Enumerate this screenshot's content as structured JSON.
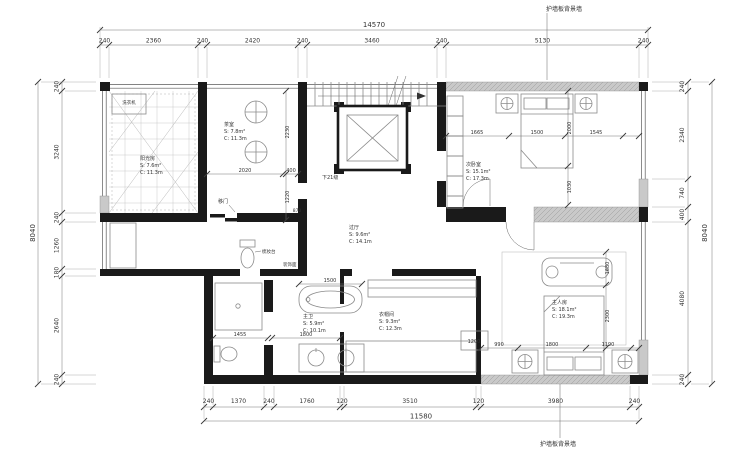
{
  "labels": {
    "panel_wall_top": "护墙板背景墙",
    "panel_wall_bottom": "护墙板背景墙",
    "stairs_note": "下21级",
    "sliding_door": "移门",
    "vanity_table": "梳妆台",
    "washer": "洗衣机",
    "deco_finish": "装饰面"
  },
  "dims": {
    "top": {
      "total": "14570",
      "segments": [
        "240",
        "2360",
        "240",
        "2420",
        "240",
        "3460",
        "240",
        "5130",
        "240"
      ]
    },
    "bottom": {
      "total": "11580",
      "segments": [
        "240",
        "1370",
        "240",
        "1760",
        "120",
        "3510",
        "120",
        "3980",
        "240"
      ]
    },
    "left": {
      "total": "8040",
      "segments": [
        "240",
        "3240",
        "240",
        "1260",
        "180",
        "2640",
        "240"
      ]
    },
    "right": {
      "total": "8040",
      "segments": [
        "240",
        "2340",
        "740",
        "400",
        "4080",
        "240"
      ]
    }
  },
  "rooms": {
    "sunroom": {
      "name": "阳光房",
      "area": "S: 7.6m²",
      "perimeter": "C: 11.3m"
    },
    "tea_room": {
      "name": "茶室",
      "area": "S: 7.8m²",
      "perimeter": "C: 11.3m"
    },
    "second_bedroom": {
      "name": "次卧室",
      "area": "S: 15.1m²",
      "perimeter": "C: 17.3m"
    },
    "hall": {
      "name": "过厅",
      "area": "S: 9.6m²",
      "perimeter": "C: 14.1m"
    },
    "master_bath": {
      "name": "主卫",
      "area": "S: 5.9m²",
      "perimeter": "C: 10.1m"
    },
    "walk_in_closet": {
      "name": "衣帽间",
      "area": "S: 9.3m²",
      "perimeter": "C: 12.3m"
    },
    "master_bedroom": {
      "name": "主人房",
      "area": "S: 18.1m²",
      "perimeter": "C: 19.3m"
    }
  },
  "interior_dims": {
    "tea_w": "2020",
    "tea_w2": "400",
    "tea_h1": "2230",
    "tea_h2": "1220",
    "door_w": "870",
    "bed2_left": "1665",
    "bed2_mid": "1500",
    "bed2_right": "1545",
    "bed2_v1": "2000",
    "bed2_v2": "1030",
    "tub_w": "1500",
    "shower_w": "1455",
    "vanity_w": "1800",
    "cabinet_w": "1200",
    "mb_left": "990",
    "mb_mid": "1800",
    "mb_right": "1190",
    "mb_v1": "1680",
    "mb_v2": "2300"
  },
  "colors": {
    "wall": "#1a1a1a",
    "panel": "#c9c9c9",
    "dimline": "#666666",
    "text": "#333333"
  }
}
